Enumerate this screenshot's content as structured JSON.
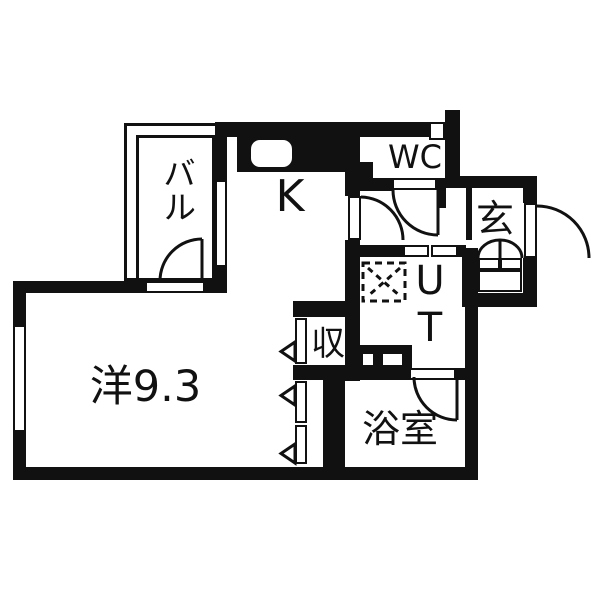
{
  "title": "floor-plan",
  "colors": {
    "wall": "#111111",
    "background": "#ffffff"
  },
  "rooms": {
    "balcony": {
      "label": "バル"
    },
    "kitchen": {
      "label": "K"
    },
    "wc": {
      "label": "WC"
    },
    "entrance": {
      "label": "玄"
    },
    "utility": {
      "label": "UT"
    },
    "storage": {
      "label": "収"
    },
    "bathroom": {
      "label": "浴室"
    },
    "main_room": {
      "label": "洋9.3"
    }
  }
}
